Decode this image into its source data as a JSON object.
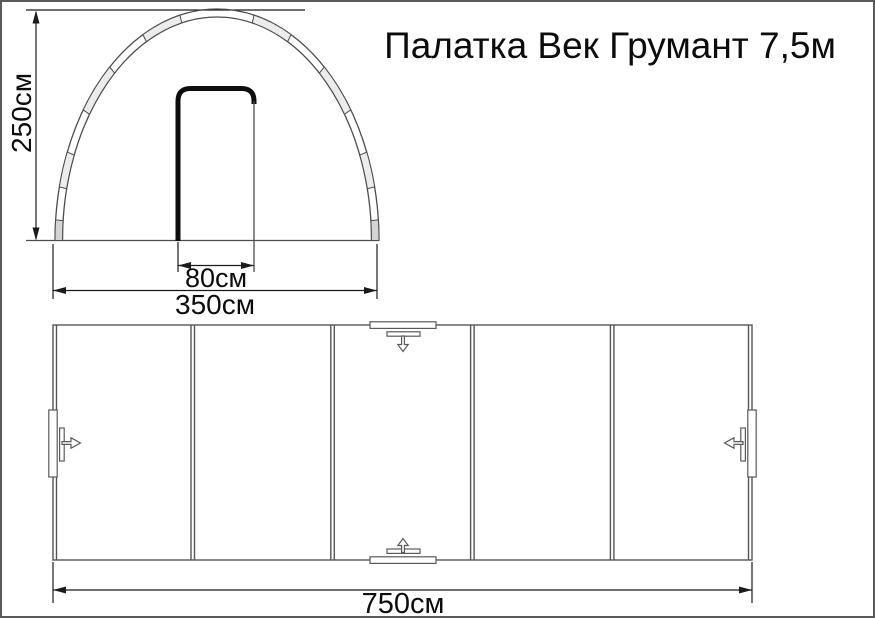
{
  "title": "Палатка Век Грумант 7,5м",
  "front_view": {
    "height_dim": "250см",
    "door_width_dim": "80см",
    "base_width_dim": "350см"
  },
  "plan_view": {
    "length_dim": "750см",
    "section_count": 5
  },
  "colors": {
    "line_gray": "#4c4c4c",
    "plan_line_gray": "#555555",
    "dimension_black": "#1b1b1b",
    "door_black": "#0d0d0d",
    "sleeve_fill": "#ececec",
    "foot_fill": "#d4d4d4",
    "symbol_fill": "#ffffff",
    "background": "#ffffff",
    "page_border": "#5a5a5a"
  }
}
